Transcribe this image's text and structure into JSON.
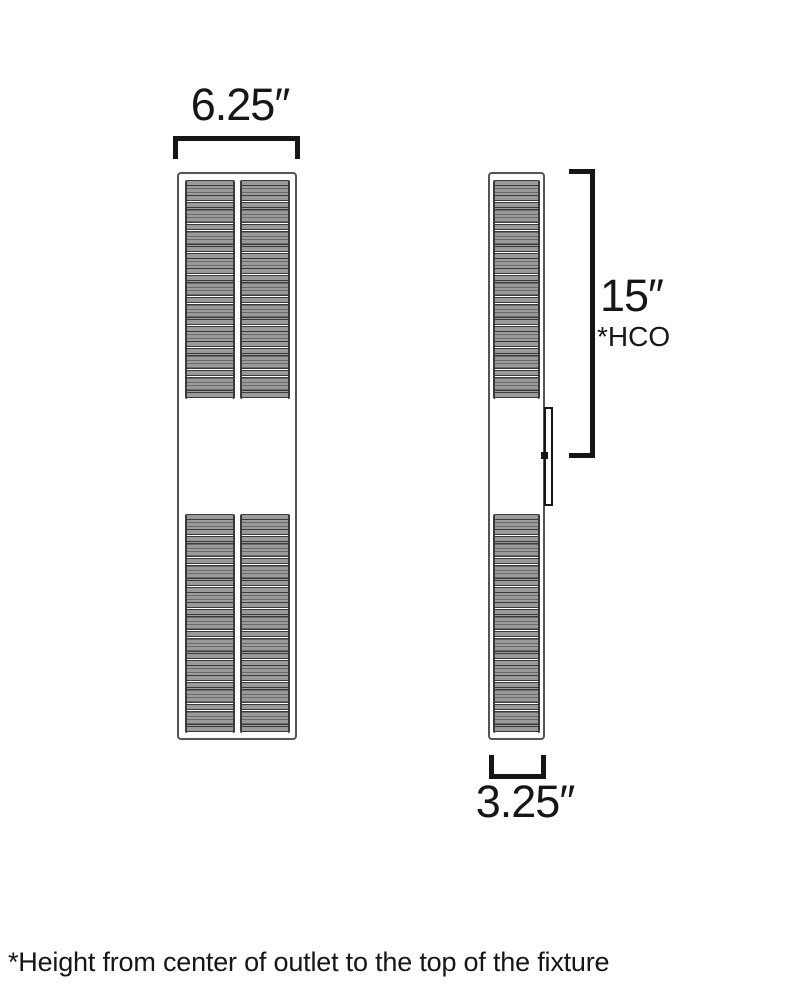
{
  "front_view": {
    "width_label": "6.25″"
  },
  "side_view": {
    "height_label": "15″",
    "height_note": "*HCO",
    "width_label": "3.25″"
  },
  "footnote": "*Height from center of outlet to the top of the fixture",
  "colors": {
    "line": "#161616",
    "fixture_outline": "#555555",
    "slat_fill": "#9a9a9a",
    "slat_edge": "#3a3a3a",
    "bg": "#ffffff"
  }
}
